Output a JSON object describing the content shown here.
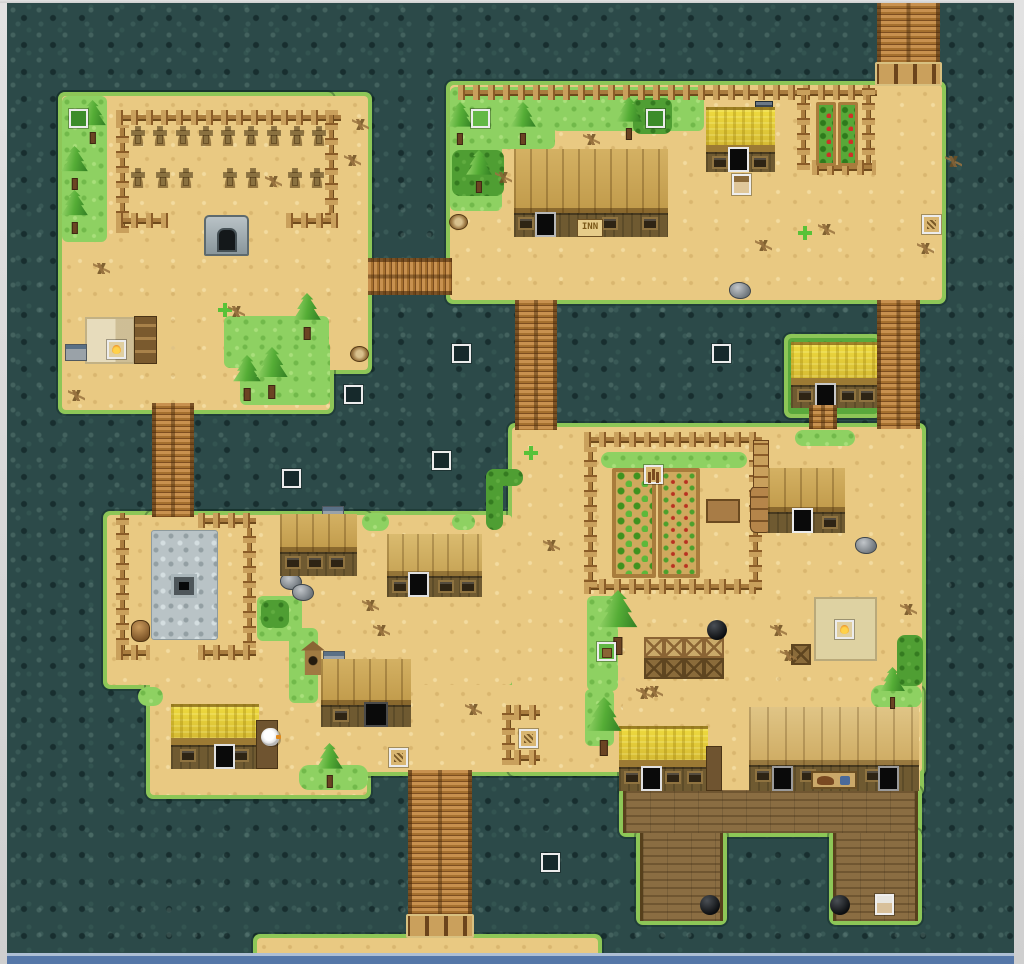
{
  "texts": {
    "inn_sign": "INN"
  },
  "palette": {
    "water": "#2c4a49",
    "sand": "#e9c982",
    "grass_light": "#8ed162",
    "grass_dark": "#4f9e33",
    "shore_fringe": "#8dc657",
    "bridge_wood": "#b3793f",
    "dock_wood": "#8a6d42",
    "roof_plank": "#c9a553",
    "roof_thatch": "#e6d33c",
    "plaza_stone": "#b9c3c6",
    "window_frame": "#d6d6d6",
    "sea_edge_strip": "#5577a8",
    "event_frame": "#ececec"
  },
  "map": {
    "islands": [
      {
        "name": "graveyard-island",
        "fill": "sand",
        "rects": [
          [
            62,
            96,
            306,
            274
          ],
          [
            62,
            96,
            268,
            314
          ]
        ]
      },
      {
        "name": "inn-island",
        "fill": "sand",
        "rects": [
          [
            450,
            85,
            492,
            215
          ]
        ]
      },
      {
        "name": "yellow-house-islet",
        "fill": "grassfill",
        "rects": [
          [
            788,
            338,
            90,
            76
          ]
        ]
      },
      {
        "name": "village-island",
        "fill": "sand",
        "rects": [
          [
            107,
            515,
            405,
            170
          ],
          [
            150,
            515,
            217,
            280
          ],
          [
            300,
            685,
            323,
            87
          ],
          [
            512,
            427,
            410,
            345
          ],
          [
            623,
            690,
            297,
            102
          ]
        ]
      },
      {
        "name": "dock",
        "fill": "wood",
        "rects": [
          [
            623,
            790,
            295,
            43
          ],
          [
            640,
            833,
            83,
            88
          ],
          [
            833,
            833,
            85,
            88
          ]
        ]
      },
      {
        "name": "south-sand-strip",
        "fill": "sand",
        "rects": [
          [
            257,
            938,
            341,
            24
          ]
        ]
      }
    ],
    "bridges": [
      {
        "name": "bridge-north",
        "x": 877,
        "y": 3,
        "w": 63,
        "h": 83,
        "dir": "v",
        "cap": true
      },
      {
        "name": "bridge-graveyard-inn",
        "x": 368,
        "y": 258,
        "w": 84,
        "h": 37,
        "dir": "h",
        "cap": false
      },
      {
        "name": "bridge-inn-village",
        "x": 515,
        "y": 300,
        "w": 42,
        "h": 130,
        "dir": "v",
        "cap": false
      },
      {
        "name": "bridge-graveyard-village",
        "x": 152,
        "y": 403,
        "w": 42,
        "h": 114,
        "dir": "v",
        "cap": false
      },
      {
        "name": "bridge-east",
        "x": 877,
        "y": 300,
        "w": 43,
        "h": 129,
        "dir": "v",
        "cap": false
      },
      {
        "name": "bridge-south",
        "x": 408,
        "y": 770,
        "w": 64,
        "h": 168,
        "dir": "v",
        "cap": true
      },
      {
        "name": "islet-steps",
        "x": 809,
        "y": 405,
        "w": 28,
        "h": 24,
        "dir": "v",
        "cap": false
      }
    ],
    "plaza": {
      "stone": [
        151,
        530,
        65,
        108
      ],
      "well": [
        171,
        574,
        26,
        24
      ]
    },
    "grass": [
      [
        62,
        96,
        45,
        146,
        "light"
      ],
      [
        224,
        316,
        105,
        52,
        "light"
      ],
      [
        240,
        341,
        90,
        64,
        "light"
      ],
      [
        450,
        87,
        105,
        62,
        "light"
      ],
      [
        450,
        87,
        52,
        124,
        "light"
      ],
      [
        552,
        87,
        152,
        44,
        "light"
      ],
      [
        633,
        98,
        39,
        36,
        "dark"
      ],
      [
        452,
        150,
        52,
        46,
        "dark"
      ],
      [
        795,
        430,
        60,
        16,
        "pill"
      ],
      [
        362,
        513,
        27,
        18,
        "pill"
      ],
      [
        452,
        514,
        23,
        16,
        "pill"
      ],
      [
        601,
        452,
        146,
        16,
        "pill"
      ],
      [
        587,
        596,
        31,
        95,
        "light"
      ],
      [
        585,
        689,
        29,
        57,
        "light"
      ],
      [
        257,
        596,
        45,
        45,
        "light"
      ],
      [
        289,
        628,
        29,
        75,
        "light"
      ],
      [
        299,
        765,
        69,
        25,
        "pill"
      ],
      [
        138,
        687,
        25,
        19,
        "pill"
      ],
      [
        871,
        685,
        51,
        23,
        "pill"
      ],
      [
        897,
        635,
        26,
        51,
        "dark"
      ],
      [
        486,
        469,
        17,
        61,
        "dark"
      ],
      [
        486,
        469,
        37,
        17,
        "dark"
      ],
      [
        261,
        600,
        28,
        28,
        "dark"
      ]
    ],
    "fences": [
      [
        116,
        110,
        225,
        "h"
      ],
      [
        116,
        125,
        108,
        "v"
      ],
      [
        325,
        110,
        110,
        "v"
      ],
      [
        116,
        213,
        52,
        "h"
      ],
      [
        286,
        213,
        52,
        "h"
      ],
      [
        458,
        85,
        419,
        "h"
      ],
      [
        797,
        88,
        82,
        "v"
      ],
      [
        862,
        88,
        82,
        "v"
      ],
      [
        812,
        160,
        64,
        "h"
      ],
      [
        584,
        432,
        178,
        "h"
      ],
      [
        584,
        579,
        178,
        "h"
      ],
      [
        584,
        447,
        140,
        "v"
      ],
      [
        749,
        447,
        140,
        "v"
      ],
      [
        116,
        513,
        147,
        "v"
      ],
      [
        198,
        513,
        58,
        "h"
      ],
      [
        243,
        528,
        120,
        "v"
      ],
      [
        116,
        645,
        34,
        "h"
      ],
      [
        198,
        645,
        58,
        "h"
      ],
      [
        502,
        705,
        60,
        "v"
      ],
      [
        514,
        705,
        26,
        "h"
      ],
      [
        514,
        750,
        26,
        "h"
      ]
    ],
    "graves": [
      {
        "y": 126,
        "xs": [
          130,
          152,
          175,
          198,
          220,
          243,
          266,
          289,
          311
        ]
      },
      {
        "y": 168,
        "xs": [
          130,
          155,
          178,
          222,
          245,
          287,
          309
        ]
      }
    ],
    "beds": [
      [
        612,
        468,
        44,
        110,
        "leafy"
      ],
      [
        658,
        468,
        42,
        110,
        "sprout"
      ],
      [
        816,
        102,
        20,
        64,
        "tomato"
      ],
      [
        838,
        102,
        20,
        64,
        "tomato"
      ]
    ],
    "buildings": [
      {
        "name": "inn",
        "x": 514,
        "y": 149,
        "w": 154,
        "h": 88,
        "roof": "plank",
        "roofH": 64,
        "windows": [
          4,
          88,
          128
        ],
        "doors": [
          {
            "dx": 21,
            "frame": "#b8b8b8"
          }
        ],
        "sign": {
          "dx": 63
        }
      },
      {
        "name": "cottage-north",
        "x": 706,
        "y": 107,
        "w": 69,
        "h": 65,
        "roof": "thatch",
        "roofH": 45,
        "windows": [
          6,
          46
        ],
        "doors": [
          {
            "dx": 22,
            "frame": "#e8e8e8"
          }
        ]
      },
      {
        "name": "islet-house",
        "x": 791,
        "y": 342,
        "w": 87,
        "h": 66,
        "roof": "thatch",
        "roofH": 43,
        "windows": [
          6,
          49,
          68
        ],
        "doors": [
          {
            "dx": 24,
            "frame": "#c8c8c8"
          }
        ]
      },
      {
        "name": "storehouse-west",
        "x": 280,
        "y": 514,
        "w": 77,
        "h": 62,
        "roof": "plank",
        "roofH": 38,
        "windows": [
          5,
          27,
          49
        ],
        "doors": []
      },
      {
        "name": "house-central",
        "x": 387,
        "y": 534,
        "w": 95,
        "h": 63,
        "roof": "plank2",
        "roofH": 42,
        "windows": [
          5,
          51,
          73
        ],
        "doors": [
          {
            "dx": 21,
            "frame": "#e0e0e0"
          }
        ]
      },
      {
        "name": "workshop-east",
        "x": 768,
        "y": 468,
        "w": 77,
        "h": 65,
        "roof": "plank",
        "roofH": 44,
        "windows": [
          54
        ],
        "doors": [
          {
            "dx": 24,
            "frame": "#ececec"
          }
        ]
      },
      {
        "name": "storehouse-south",
        "x": 321,
        "y": 659,
        "w": 90,
        "h": 68,
        "roof": "plank",
        "roofH": 46,
        "windows": [
          12
        ],
        "doors": [
          {
            "dx": 43,
            "frame": "#4a4a4a",
            "w": 24
          }
        ]
      },
      {
        "name": "shop-south",
        "x": 171,
        "y": 704,
        "w": 88,
        "h": 65,
        "roof": "thatch",
        "roofH": 41,
        "windows": [
          9,
          62
        ],
        "doors": [
          {
            "dx": 43,
            "frame": "#e0e0e0"
          }
        ],
        "annex": {
          "dx": 85,
          "dy": 16,
          "w": 22,
          "h": 49
        }
      },
      {
        "name": "house-south",
        "x": 619,
        "y": 726,
        "w": 89,
        "h": 65,
        "roof": "thatch",
        "roofH": 41,
        "windows": [
          5,
          46,
          68
        ],
        "doors": [
          {
            "dx": 22,
            "frame": "#e0e0e0"
          }
        ],
        "annex": {
          "dx": 87,
          "dy": 20,
          "w": 16,
          "h": 45
        }
      },
      {
        "name": "stable",
        "x": 749,
        "y": 707,
        "w": 170,
        "h": 84,
        "roof": "plank-light",
        "roofH": 58,
        "windows": [
          6,
          51,
          116
        ],
        "doors": [
          {
            "dx": 23,
            "frame": "#9a9a9a"
          },
          {
            "dx": 129,
            "frame": "#9a9a9a"
          }
        ],
        "hsign": {
          "dx": 62
        }
      }
    ],
    "trees": [
      [
        78,
        100,
        46
      ],
      [
        60,
        146,
        46
      ],
      [
        60,
        190,
        46
      ],
      [
        232,
        355,
        48
      ],
      [
        255,
        347,
        55
      ],
      [
        292,
        293,
        49
      ],
      [
        446,
        102,
        45
      ],
      [
        509,
        102,
        45
      ],
      [
        465,
        150,
        45
      ],
      [
        615,
        97,
        45
      ],
      [
        315,
        743,
        47
      ],
      [
        597,
        590,
        68
      ],
      [
        585,
        697,
        62
      ],
      [
        879,
        667,
        44
      ]
    ],
    "events": [
      {
        "x": 69,
        "y": 109,
        "kind": "grass-dark",
        "name": "event-grove-nw"
      },
      {
        "x": 471,
        "y": 109,
        "kind": "grass",
        "name": "event-inn-grove-1"
      },
      {
        "x": 646,
        "y": 109,
        "kind": "grass-dark",
        "name": "event-inn-grove-2"
      },
      {
        "x": 922,
        "y": 215,
        "kind": "sign",
        "name": "event-sign-inn-east"
      },
      {
        "x": 452,
        "y": 344,
        "kind": "water",
        "name": "event-water-1"
      },
      {
        "x": 344,
        "y": 385,
        "kind": "water",
        "name": "event-water-2"
      },
      {
        "x": 282,
        "y": 469,
        "kind": "water",
        "name": "event-water-3"
      },
      {
        "x": 432,
        "y": 451,
        "kind": "water",
        "name": "event-water-4"
      },
      {
        "x": 712,
        "y": 344,
        "kind": "water",
        "name": "event-water-5"
      },
      {
        "x": 541,
        "y": 853,
        "kind": "water",
        "name": "event-water-6"
      },
      {
        "x": 644,
        "y": 465,
        "kind": "scarecrow",
        "name": "event-scarecrow"
      },
      {
        "x": 835,
        "y": 620,
        "kind": "campfire",
        "name": "event-campfire-east"
      },
      {
        "x": 107,
        "y": 340,
        "kind": "campfire",
        "name": "event-campfire-hut"
      },
      {
        "x": 597,
        "y": 642,
        "kind": "grass-obj",
        "name": "event-grove-item"
      },
      {
        "x": 389,
        "y": 748,
        "kind": "sign",
        "name": "event-sign-south"
      },
      {
        "x": 519,
        "y": 729,
        "kind": "sign",
        "name": "event-pen"
      }
    ],
    "npcs": [
      {
        "x": 732,
        "y": 174,
        "kind": "portrait",
        "name": "npc-villager-north"
      },
      {
        "x": 875,
        "y": 894,
        "kind": "oldman",
        "name": "npc-dock-elder"
      },
      {
        "x": 261,
        "y": 728,
        "kind": "goose",
        "name": "npc-goose"
      }
    ],
    "props": [
      [
        "crypt",
        204,
        215
      ],
      [
        "barrel",
        131,
        620
      ],
      [
        "barrelstack",
        750,
        486
      ],
      [
        "pillar",
        753,
        440
      ],
      [
        "mat",
        814,
        597,
        63,
        64
      ],
      [
        "hutmat",
        85,
        317,
        50,
        47
      ],
      [
        "shelf",
        134,
        316,
        23,
        48
      ],
      [
        "stove",
        322,
        506
      ],
      [
        "stove",
        323,
        651
      ],
      [
        "stove",
        65,
        344
      ],
      [
        "chimdark",
        755,
        101
      ],
      [
        "cratel",
        644,
        637
      ],
      [
        "cratel",
        664,
        637
      ],
      [
        "cratel",
        684,
        637
      ],
      [
        "cratel",
        704,
        637
      ],
      [
        "crated",
        644,
        658
      ],
      [
        "crated",
        664,
        658
      ],
      [
        "crated",
        684,
        658
      ],
      [
        "crated",
        704,
        658
      ],
      [
        "crated",
        791,
        644
      ],
      [
        "bench",
        706,
        499,
        34,
        24
      ],
      [
        "rock",
        729,
        282
      ],
      [
        "rock",
        855,
        537
      ],
      [
        "rock",
        280,
        573
      ],
      [
        "rock",
        292,
        584
      ],
      [
        "stump",
        350,
        346
      ],
      [
        "stump",
        449,
        214
      ],
      [
        "pot",
        707,
        620
      ],
      [
        "pot",
        700,
        895
      ],
      [
        "pot",
        830,
        895
      ],
      [
        "birdhouse",
        301,
        641
      ],
      [
        "sparkle",
        218,
        303
      ],
      [
        "sparkle",
        798,
        226
      ],
      [
        "sparkle",
        524,
        446
      ],
      [
        "debris",
        93,
        263
      ],
      [
        "debris",
        352,
        119
      ],
      [
        "debris",
        344,
        155
      ],
      [
        "debris",
        265,
        176
      ],
      [
        "debris",
        583,
        134
      ],
      [
        "debris",
        755,
        240
      ],
      [
        "debris",
        945,
        156
      ],
      [
        "debris",
        543,
        540
      ],
      [
        "debris",
        362,
        600
      ],
      [
        "debris",
        373,
        625
      ],
      [
        "debris",
        465,
        704
      ],
      [
        "debris",
        646,
        686
      ],
      [
        "debris",
        770,
        625
      ],
      [
        "debris",
        780,
        650
      ],
      [
        "debris",
        900,
        604
      ],
      [
        "debris",
        636,
        688
      ],
      [
        "debris",
        818,
        224
      ],
      [
        "debris",
        68,
        390
      ],
      [
        "debris",
        228,
        306
      ],
      [
        "debris",
        495,
        172
      ],
      [
        "debris",
        917,
        243
      ]
    ]
  }
}
